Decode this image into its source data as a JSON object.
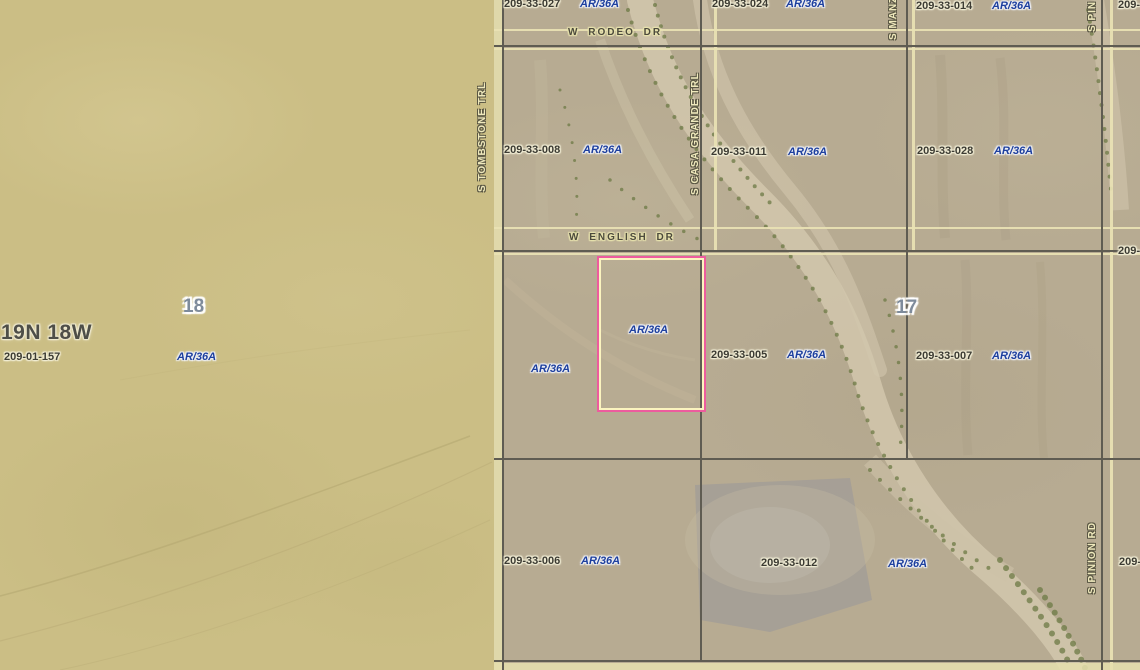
{
  "township": "19N 18W",
  "sections": {
    "left": "18",
    "right": "17"
  },
  "streets": {
    "rodeo": "W RODEO DR",
    "english": "W ENGLISH DR",
    "tombstone": "S TOMBSTONE TRL",
    "casa_grande": "S CASA GRANDE TRL",
    "manzanita_partial": "S MANZ",
    "pinion": "S PINION RD",
    "pinion_partial": "S PIN"
  },
  "parcels": [
    {
      "apn": "209-33-027",
      "zone": "AR/36A"
    },
    {
      "apn": "209-33-024",
      "zone": "AR/36A"
    },
    {
      "apn": "209-33-014",
      "zone": "AR/36A"
    },
    {
      "apn": "209-33-008",
      "zone": "AR/36A"
    },
    {
      "apn": "209-33-011",
      "zone": "AR/36A"
    },
    {
      "apn": "209-33-028",
      "zone": "AR/36A"
    },
    {
      "apn": "209-33-005",
      "zone": "AR/36A"
    },
    {
      "apn": "209-33-007",
      "zone": "AR/36A"
    },
    {
      "apn": "209-33-006",
      "zone": "AR/36A"
    },
    {
      "apn": "209-33-012",
      "zone": "AR/36A"
    },
    {
      "apn": "209-01-157",
      "zone": "AR/36A"
    }
  ],
  "highlighted_parcel": {
    "zone": "AR/36A"
  },
  "zones_extra": {
    "west_of_highlight": "AR/36A"
  },
  "partial_apns": [
    "209-",
    "209-",
    "209-"
  ],
  "colors": {
    "highlight_outline": "#ed5c9e",
    "highlight_inner": "#fbf4bf",
    "zone_text": "#1d3f9e",
    "parcel_line": "#5f5c52",
    "road_casing": "#e9e2b4",
    "terrain_left": "#cbbe85",
    "terrain_right": "#b7ab92"
  }
}
